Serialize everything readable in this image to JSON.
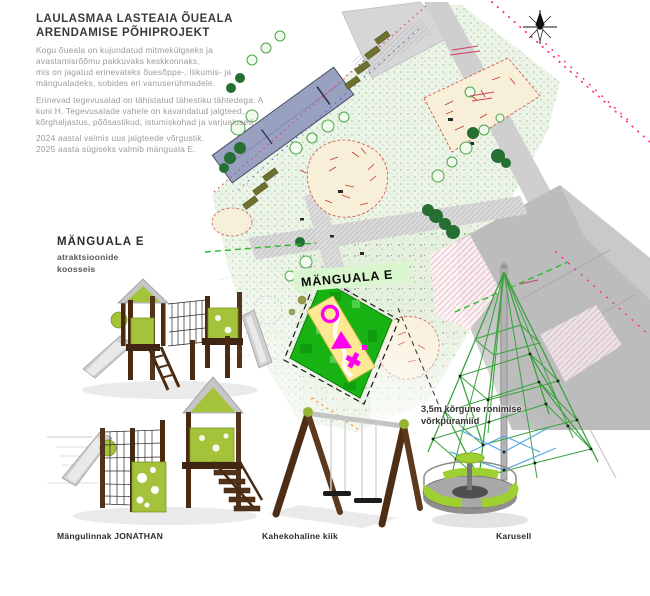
{
  "doc": {
    "title_line1": "LAULASMAA LASTEAIA ÕUEALA",
    "title_line2": "ARENDAMISE PÕHIPROJEKT",
    "para1_lines": [
      "Kogu õueala on kujundatud mitmekülgseks ja",
      "avastamisrõõmu pakkuvaks keskkonnaks,",
      "mis on jagatud erinevateks õuesõppe-, liikumis- ja",
      "mängualadeks, sobides eri vanuserühmadele."
    ],
    "para2_lines": [
      "Erinevad tegevusalad on tähistatud tähestiku tähtedega: A",
      "kuni H. Tegevusalade vahele on kavandatud jalgteed,",
      "kõrghaljastus, põõsastikud, istumiskohad ja varjualused."
    ],
    "para3_lines": [
      "2024 aastal valmis uus jalgteede võrgustik.",
      "2025 aasta sügiseks valmib mänguala E."
    ]
  },
  "playarea_section": {
    "heading": "MÄNGUALA E",
    "sub_lines": [
      "atraktsioonide",
      "koosseis"
    ]
  },
  "map": {
    "area_label": "MÄNGUALA E",
    "colors": {
      "highlight_green": "#18b312",
      "sand_yellow": "#ffe894",
      "glyph_magenta": "#ff00f0",
      "building_blue_gray": "#99a1c0",
      "beige_area": "#f8efd8",
      "road_gray": "#cfcfcf",
      "parking_gray": "#bcbcbc",
      "boundary_pink": "#ff2d8d",
      "vegetation_green": "#9cc49a"
    }
  },
  "equipment_labels": {
    "playhouse": "Mängulinnak JONATHAN",
    "swing": "Kahekohaline kiik",
    "carousel": "Karusell"
  },
  "pyramid_note_lines": [
    "3,5m kõrgune ronimise",
    "võrkpüramiid"
  ]
}
